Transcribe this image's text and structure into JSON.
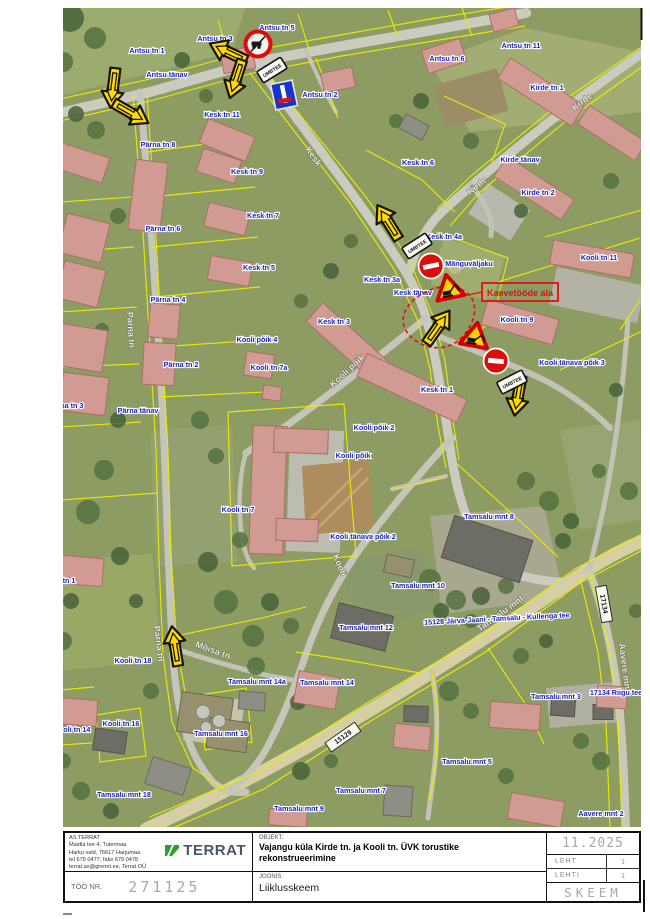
{
  "title_block": {
    "company": {
      "lines": [
        "AS TERRAT",
        "Maidla tee 4, Tutermaa",
        "Harku vald, 76617 Harjumaa",
        "tel 679 0477; faks 679 0478",
        "terrat.as@grenet.ee, Terrat OÜ"
      ],
      "logo_text": "TERRAT"
    },
    "objekt_label": "OBJEKT:",
    "objekt_value": "Vajangu küla Kirde tn. ja Kooli tn. ÜVK torustike rekonstrueerimine",
    "joonis_label": "JOONIS:",
    "joonis_value": "Liiklusskeem",
    "too_nr_label": "TÖÖ NR.",
    "too_nr_value": "271125",
    "date": "11.2025",
    "leht_label": "LEHT",
    "leht_value": "1",
    "lehti_label": "LEHTI",
    "lehti_value": "1",
    "stage": "SKEEM"
  },
  "map": {
    "work_zone_label": "Kaevetööde ala",
    "umbtee_text": "UMBTEE",
    "labels": [
      {
        "t": "Antsu tn 5",
        "x": 277,
        "y": 30
      },
      {
        "t": "Antsu tn 3",
        "x": 215,
        "y": 41
      },
      {
        "t": "Antsu tn 1",
        "x": 147,
        "y": 53
      },
      {
        "t": "Antsu tänav",
        "x": 167,
        "y": 77
      },
      {
        "t": "Antsu tn 2",
        "x": 320,
        "y": 97
      },
      {
        "t": "Antsu tn 6",
        "x": 447,
        "y": 61
      },
      {
        "t": "Antsu tn 11",
        "x": 521,
        "y": 48
      },
      {
        "t": "Kirde tn 1",
        "x": 547,
        "y": 90
      },
      {
        "t": "Kirde tänav",
        "x": 520,
        "y": 162
      },
      {
        "t": "Kirde tn 2",
        "x": 538,
        "y": 195
      },
      {
        "t": "Kesk tn 11",
        "x": 222,
        "y": 117
      },
      {
        "t": "Kesk tn 9",
        "x": 247,
        "y": 174
      },
      {
        "t": "Kesk tn 7",
        "x": 263,
        "y": 218
      },
      {
        "t": "Kesk tn 5",
        "x": 259,
        "y": 270
      },
      {
        "t": "Kesk tn 6",
        "x": 418,
        "y": 165
      },
      {
        "t": "Kesk tn 4a",
        "x": 444,
        "y": 239
      },
      {
        "t": "Kesk tn 3a",
        "x": 382,
        "y": 282
      },
      {
        "t": "Kesk tänav",
        "x": 413,
        "y": 295
      },
      {
        "t": "Mänguväljaku",
        "x": 469,
        "y": 266
      },
      {
        "t": "Kooli tn 9",
        "x": 517,
        "y": 322
      },
      {
        "t": "Kooli tn 11",
        "x": 599,
        "y": 260
      },
      {
        "t": "Kooli tänava põik 3",
        "x": 572,
        "y": 365
      },
      {
        "t": "Kesk tn 3",
        "x": 334,
        "y": 324
      },
      {
        "t": "Kesk tn 1",
        "x": 437,
        "y": 392
      },
      {
        "t": "Pärna tn 8",
        "x": 158,
        "y": 147
      },
      {
        "t": "Pärna tn 6",
        "x": 163,
        "y": 231
      },
      {
        "t": "Pärna tn 4",
        "x": 168,
        "y": 302
      },
      {
        "t": "Pärna tn 2",
        "x": 181,
        "y": 367
      },
      {
        "t": "Pärna tänav",
        "x": 138,
        "y": 413
      },
      {
        "t": "Pärna tn 3",
        "x": 66,
        "y": 408
      },
      {
        "t": "Pärna tn 1",
        "x": 58,
        "y": 583
      },
      {
        "t": "Kooli põik 4",
        "x": 257,
        "y": 342
      },
      {
        "t": "Kooli tn 7a",
        "x": 269,
        "y": 370
      },
      {
        "t": "Kooli põik 2",
        "x": 374,
        "y": 430
      },
      {
        "t": "Kooli põik",
        "x": 353,
        "y": 458
      },
      {
        "t": "Kooli tn 7",
        "x": 238,
        "y": 512
      },
      {
        "t": "Kooli tänava põik 2",
        "x": 363,
        "y": 539
      },
      {
        "t": "Tamsalu mnt 8",
        "x": 489,
        "y": 519
      },
      {
        "t": "Tamsalu mnt 10",
        "x": 418,
        "y": 588
      },
      {
        "t": "Tamsalu mnt 12",
        "x": 366,
        "y": 630
      },
      {
        "t": "Tamsalu mnt 14a",
        "x": 257,
        "y": 684
      },
      {
        "t": "Tamsalu mnt 14",
        "x": 327,
        "y": 685
      },
      {
        "t": "Kooli tn 18",
        "x": 133,
        "y": 663
      },
      {
        "t": "Kooli tn 16",
        "x": 121,
        "y": 726
      },
      {
        "t": "Kooli tn 14",
        "x": 72,
        "y": 732
      },
      {
        "t": "Tamsalu mnt 16",
        "x": 221,
        "y": 736
      },
      {
        "t": "Tamsalu mnt 18",
        "x": 124,
        "y": 797
      },
      {
        "t": "Tamsalu mnt 9",
        "x": 299,
        "y": 811
      },
      {
        "t": "Tamsalu mnt 7",
        "x": 361,
        "y": 793
      },
      {
        "t": "Tamsalu mnt 5",
        "x": 467,
        "y": 764
      },
      {
        "t": "Tamsalu mnt 3",
        "x": 556,
        "y": 699
      },
      {
        "t": "Aavere mnt 2",
        "x": 601,
        "y": 816
      },
      {
        "t": "15128 Järva-Jaani - Tamsalu - Kullenga tee",
        "x": 497,
        "y": 621,
        "r": -3
      },
      {
        "t": "17134 Riigu tee",
        "x": 616,
        "y": 695
      }
    ],
    "road_labels": [
      {
        "t": "Kesk",
        "x": 311,
        "y": 158,
        "r": 56
      },
      {
        "t": "Kirde",
        "x": 584,
        "y": 104,
        "r": -38
      },
      {
        "t": "Kirde",
        "x": 479,
        "y": 188,
        "r": -40
      },
      {
        "t": "Kooli põik",
        "x": 349,
        "y": 373,
        "r": -43
      },
      {
        "t": "Kooli",
        "x": 337,
        "y": 566,
        "r": 68
      },
      {
        "t": "Tamsalu mnt",
        "x": 502,
        "y": 616,
        "r": -36
      },
      {
        "t": "Aavere mnt",
        "x": 622,
        "y": 668,
        "r": 83
      },
      {
        "t": "Pärna tn",
        "x": 128,
        "y": 330,
        "r": 87
      },
      {
        "t": "Pärna tn",
        "x": 156,
        "y": 644,
        "r": 83
      },
      {
        "t": "Mõisa tn",
        "x": 212,
        "y": 653,
        "r": 20
      }
    ],
    "road_number_plates": [
      {
        "t": "17134",
        "x": 604,
        "y": 604,
        "r": 80
      },
      {
        "t": "15129",
        "x": 343,
        "y": 737,
        "r": -35
      }
    ],
    "signs": [
      {
        "type": "no-vehicles",
        "x": 258,
        "y": 44,
        "r": 0
      },
      {
        "type": "detour-arrow",
        "x": 113,
        "y": 88,
        "r": 97
      },
      {
        "type": "detour-arrow",
        "x": 131,
        "y": 113,
        "r": 30
      },
      {
        "type": "detour-arrow",
        "x": 228,
        "y": 52,
        "r": 205
      },
      {
        "type": "detour-arrow",
        "x": 236,
        "y": 79,
        "r": 108
      },
      {
        "type": "detour-arrow",
        "x": 388,
        "y": 222,
        "r": -122
      },
      {
        "type": "detour-arrow",
        "x": 438,
        "y": 327,
        "r": -55
      },
      {
        "type": "detour-arrow",
        "x": 518,
        "y": 396,
        "r": 100
      },
      {
        "type": "detour-arrow",
        "x": 175,
        "y": 646,
        "r": -99
      },
      {
        "type": "no-entry",
        "x": 431,
        "y": 266,
        "r": -12
      },
      {
        "type": "no-entry",
        "x": 496,
        "y": 361,
        "r": 5
      },
      {
        "type": "works",
        "x": 449,
        "y": 289,
        "r": -12
      },
      {
        "type": "works",
        "x": 475,
        "y": 337,
        "r": 10
      },
      {
        "type": "umbtee",
        "x": 272,
        "y": 70,
        "r": -32
      },
      {
        "type": "umbtee",
        "x": 417,
        "y": 246,
        "r": -33
      },
      {
        "type": "umbtee",
        "x": 512,
        "y": 382,
        "r": -27
      },
      {
        "type": "dead-end",
        "x": 284,
        "y": 95,
        "r": -12
      }
    ]
  },
  "colors": {
    "label_blue": "#1c22c4",
    "cadastral_yellow": "#ecec00",
    "sign_red": "#dd0d0d",
    "sign_yellow": "#ffd900",
    "work_zone_red": "#e01010",
    "logo_green": "#2f9e2f"
  }
}
